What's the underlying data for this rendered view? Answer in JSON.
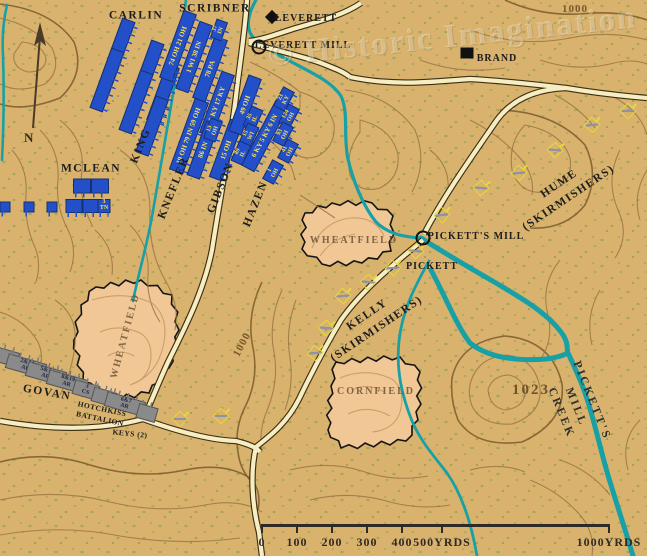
{
  "watermark": {
    "text": "© Historic Imagination"
  },
  "compass": {
    "label": "N"
  },
  "colors": {
    "background": "#d9b26e",
    "union": "#2350c8",
    "union_text": "#ffe14d",
    "confederate": "#8a8a8a",
    "confederate_text": "#1a2342",
    "creek": "#17a0a6",
    "road": "#f6edc2",
    "field": "#f0c795",
    "contour": "#9a7544",
    "skirmisher": "#e6d83c"
  },
  "labels": [
    {
      "t": "CARLIN",
      "x": 136,
      "y": 16,
      "r": 0,
      "c": "lbl-brigade"
    },
    {
      "t": "SCRIBNER",
      "x": 215,
      "y": 9,
      "r": 0,
      "c": "lbl-brigade"
    },
    {
      "t": "MCLEAN",
      "x": 91,
      "y": 169,
      "r": 0,
      "c": "lbl-brigade"
    },
    {
      "t": "KING",
      "x": 141,
      "y": 146,
      "r": -68,
      "c": "lbl-brigade"
    },
    {
      "t": "KNEFLER",
      "x": 174,
      "y": 188,
      "r": -68,
      "c": "lbl-brigade"
    },
    {
      "t": "GIBSON",
      "x": 221,
      "y": 188,
      "r": -68,
      "c": "lbl-brigade"
    },
    {
      "t": "HAZEN",
      "x": 256,
      "y": 204,
      "r": -68,
      "c": "lbl-brigade"
    },
    {
      "t": "GOVAN",
      "x": 47,
      "y": 393,
      "r": 10,
      "c": "lbl-brigade"
    },
    {
      "t": "HOTCHKISS\nBATTALION",
      "x": 101,
      "y": 414,
      "r": 12,
      "c": "lbl-road"
    },
    {
      "t": "KEYS (2)",
      "x": 130,
      "y": 434,
      "r": 6,
      "c": "lbl-road"
    },
    {
      "t": "KELLY\n(SKIRMISHERS)",
      "x": 372,
      "y": 322,
      "r": -34,
      "c": "lbl-brigade"
    },
    {
      "t": "HUME\n(SKIRMISHERS)",
      "x": 564,
      "y": 191,
      "r": -34,
      "c": "lbl-brigade"
    },
    {
      "t": "WHEATFIELD",
      "x": 354,
      "y": 241,
      "r": 0,
      "c": "lbl-field"
    },
    {
      "t": "WHEATFIELD",
      "x": 126,
      "y": 336,
      "r": -75,
      "c": "lbl-field"
    },
    {
      "t": "CORNFIELD",
      "x": 376,
      "y": 392,
      "r": 0,
      "c": "lbl-field"
    },
    {
      "t": "PICKETT",
      "x": 432,
      "y": 267,
      "r": 0,
      "c": "lbl-place"
    },
    {
      "t": "PICKETT'S MILL",
      "x": 476,
      "y": 237,
      "r": 0,
      "c": "lbl-place"
    },
    {
      "t": "LEVERETT",
      "x": 306,
      "y": 19,
      "r": 0,
      "c": "lbl-place"
    },
    {
      "t": "LEVERETT MILL",
      "x": 303,
      "y": 46,
      "r": 0,
      "c": "lbl-place"
    },
    {
      "t": "BRAND",
      "x": 497,
      "y": 59,
      "r": 0,
      "c": "lbl-place"
    },
    {
      "t": "PICKETT'S MILL CREEK",
      "x": 576,
      "y": 407,
      "r": 68,
      "c": "lbl-creek"
    },
    {
      "t": "1000",
      "x": 575,
      "y": 10,
      "r": 0,
      "c": "lbl-elev"
    },
    {
      "t": "1000",
      "x": 243,
      "y": 345,
      "r": -62,
      "c": "lbl-elev"
    },
    {
      "t": "1023",
      "x": 531,
      "y": 391,
      "r": 0,
      "c": "lbl-elev-big"
    }
  ],
  "units": {
    "union": [
      {
        "x": 118,
        "y": 50,
        "w": 62,
        "h": 12,
        "r": -70,
        "t": ""
      },
      {
        "x": 147,
        "y": 72,
        "w": 62,
        "h": 12,
        "r": -70,
        "t": ""
      },
      {
        "x": 107,
        "y": 80,
        "w": 62,
        "h": 12,
        "r": -70,
        "t": ""
      },
      {
        "x": 136,
        "y": 102,
        "w": 62,
        "h": 12,
        "r": -70,
        "t": ""
      },
      {
        "x": 163,
        "y": 94,
        "w": 58,
        "h": 12,
        "r": -70,
        "t": ""
      },
      {
        "x": 152,
        "y": 126,
        "w": 58,
        "h": 12,
        "r": -70,
        "t": ""
      },
      {
        "x": 178,
        "y": 46,
        "w": 70,
        "h": 12,
        "r": -70,
        "t": "74 OH 21 OH"
      },
      {
        "x": 194,
        "y": 57,
        "w": 70,
        "h": 12,
        "r": -70,
        "t": "1 WI 38 IN"
      },
      {
        "x": 210,
        "y": 69,
        "w": 64,
        "h": 12,
        "r": -70,
        "t": "78 PA"
      },
      {
        "x": 219,
        "y": 30,
        "w": 18,
        "h": 10,
        "r": -70,
        "t": "37 IN",
        "small": true
      },
      {
        "x": 189,
        "y": 136,
        "w": 74,
        "h": 13,
        "r": -70,
        "t": "19 OH 79 IN 59 OH"
      },
      {
        "x": 217,
        "y": 104,
        "w": 64,
        "h": 12,
        "r": -70,
        "t": "9 KY 17 KY"
      },
      {
        "x": 203,
        "y": 150,
        "w": 56,
        "h": 12,
        "r": -70,
        "t": "86 IN"
      },
      {
        "x": 213,
        "y": 130,
        "w": 20,
        "h": 11,
        "r": -70,
        "t": "13 OH",
        "small": true
      },
      {
        "x": 226,
        "y": 150,
        "w": 60,
        "h": 12,
        "r": -70,
        "t": "15 OH"
      },
      {
        "x": 245,
        "y": 105,
        "w": 58,
        "h": 12,
        "r": -70,
        "t": "49 OH"
      },
      {
        "x": 253,
        "y": 118,
        "w": 20,
        "h": 11,
        "r": -66,
        "t": "35 IL",
        "small": true
      },
      {
        "x": 249,
        "y": 135,
        "w": 20,
        "h": 11,
        "r": -66,
        "t": "15 WI",
        "small": true
      },
      {
        "x": 241,
        "y": 153,
        "w": 20,
        "h": 11,
        "r": -66,
        "t": "89 IL",
        "small": true
      },
      {
        "x": 265,
        "y": 136,
        "w": 72,
        "h": 13,
        "r": -62,
        "t": "6 KY 5 KY 6 IN"
      },
      {
        "x": 284,
        "y": 99,
        "w": 20,
        "h": 11,
        "r": -62,
        "t": "23 KY",
        "small": true
      },
      {
        "x": 289,
        "y": 116,
        "w": 20,
        "h": 11,
        "r": -62,
        "t": "124 OH",
        "small": true
      },
      {
        "x": 283,
        "y": 134,
        "w": 20,
        "h": 11,
        "r": -62,
        "t": "93 OH",
        "small": true
      },
      {
        "x": 288,
        "y": 151,
        "w": 20,
        "h": 11,
        "r": -62,
        "t": "41 OH",
        "small": true
      },
      {
        "x": 273,
        "y": 172,
        "w": 20,
        "h": 11,
        "r": -62,
        "t": "1 OH",
        "small": true
      }
    ],
    "confederate": [
      {
        "x": -4,
        "y": 354,
        "w": 44,
        "h": 13,
        "r": 16,
        "t": ""
      },
      {
        "x": 26,
        "y": 366,
        "w": 38,
        "h": 13,
        "r": 16,
        "t": "2&24 AR"
      },
      {
        "x": 46,
        "y": 374,
        "w": 38,
        "h": 13,
        "r": 16,
        "t": "5&13 AR"
      },
      {
        "x": 67,
        "y": 382,
        "w": 38,
        "h": 13,
        "r": 16,
        "t": "8&19 AR"
      },
      {
        "x": 86,
        "y": 390,
        "w": 24,
        "h": 13,
        "r": 16,
        "t": "3 CS"
      },
      {
        "x": 104,
        "y": 397,
        "w": 22,
        "h": 13,
        "r": 16,
        "t": ""
      },
      {
        "x": 125,
        "y": 404,
        "w": 38,
        "h": 13,
        "r": 16,
        "t": "6&7 AR"
      },
      {
        "x": 147,
        "y": 413,
        "w": 18,
        "h": 13,
        "r": 16,
        "t": ""
      }
    ],
    "mclean": [
      {
        "x": 82,
        "y": 186,
        "w": 16,
        "h": 13,
        "r": 0,
        "t": ""
      },
      {
        "x": 100,
        "y": 186,
        "w": 16,
        "h": 13,
        "r": 0,
        "t": ""
      },
      {
        "x": 74,
        "y": 206,
        "w": 15,
        "h": 12,
        "r": 0,
        "t": ""
      },
      {
        "x": 91,
        "y": 206,
        "w": 15,
        "h": 12,
        "r": 0,
        "t": ""
      },
      {
        "x": 104,
        "y": 206,
        "w": 11,
        "h": 12,
        "r": 0,
        "t": "3 TN",
        "small": true
      },
      {
        "x": 5,
        "y": 207,
        "w": 9,
        "h": 9,
        "r": 0,
        "t": ""
      },
      {
        "x": 29,
        "y": 207,
        "w": 9,
        "h": 9,
        "r": 0,
        "t": ""
      },
      {
        "x": 52,
        "y": 207,
        "w": 9,
        "h": 9,
        "r": 0,
        "t": ""
      }
    ]
  },
  "skirmishers": [
    [
      442,
      215,
      40
    ],
    [
      416,
      251,
      50
    ],
    [
      393,
      268,
      40
    ],
    [
      368,
      282,
      50
    ],
    [
      343,
      296,
      40
    ],
    [
      326,
      328,
      50
    ],
    [
      315,
      353,
      40
    ],
    [
      180,
      419,
      45
    ],
    [
      221,
      416,
      45
    ],
    [
      592,
      125,
      40
    ],
    [
      555,
      150,
      50
    ],
    [
      519,
      173,
      40
    ],
    [
      481,
      188,
      50
    ],
    [
      628,
      111,
      45
    ]
  ],
  "poi": [
    {
      "type": "diamond",
      "x": 272,
      "y": 17,
      "name": "leverett-building"
    },
    {
      "type": "square",
      "x": 467,
      "y": 53,
      "name": "brand-building"
    },
    {
      "type": "mill",
      "x": 259,
      "y": 47,
      "name": "leverett-mill-symbol"
    },
    {
      "type": "mill",
      "x": 423,
      "y": 238,
      "name": "picketts-mill-symbol"
    }
  ],
  "fields": [
    {
      "name": "wheatfield-right",
      "points": [
        [
          305,
          213
        ],
        [
          332,
          203
        ],
        [
          372,
          203
        ],
        [
          393,
          216
        ],
        [
          391,
          251
        ],
        [
          362,
          263
        ],
        [
          322,
          264
        ],
        [
          302,
          249
        ]
      ]
    },
    {
      "name": "wheatfield-left",
      "points": [
        [
          96,
          287
        ],
        [
          141,
          280
        ],
        [
          172,
          295
        ],
        [
          179,
          330
        ],
        [
          169,
          368
        ],
        [
          149,
          393
        ],
        [
          112,
          399
        ],
        [
          83,
          381
        ],
        [
          74,
          340
        ],
        [
          81,
          305
        ]
      ]
    },
    {
      "name": "cornfield",
      "points": [
        [
          336,
          362
        ],
        [
          400,
          357
        ],
        [
          420,
          372
        ],
        [
          418,
          420
        ],
        [
          406,
          441
        ],
        [
          341,
          448
        ],
        [
          328,
          430
        ],
        [
          331,
          386
        ]
      ]
    }
  ],
  "scale": {
    "bar_y": 524,
    "x0": 262,
    "x1": 609,
    "ticks": [
      {
        "x": 262,
        "label": "0"
      },
      {
        "x": 297,
        "label": "100"
      },
      {
        "x": 332,
        "label": "200"
      },
      {
        "x": 367,
        "label": "300"
      },
      {
        "x": 402,
        "label": "400"
      },
      {
        "x": 442,
        "label": "500YRDS"
      }
    ],
    "end": {
      "x": 609,
      "label": "1000YRDS"
    }
  }
}
